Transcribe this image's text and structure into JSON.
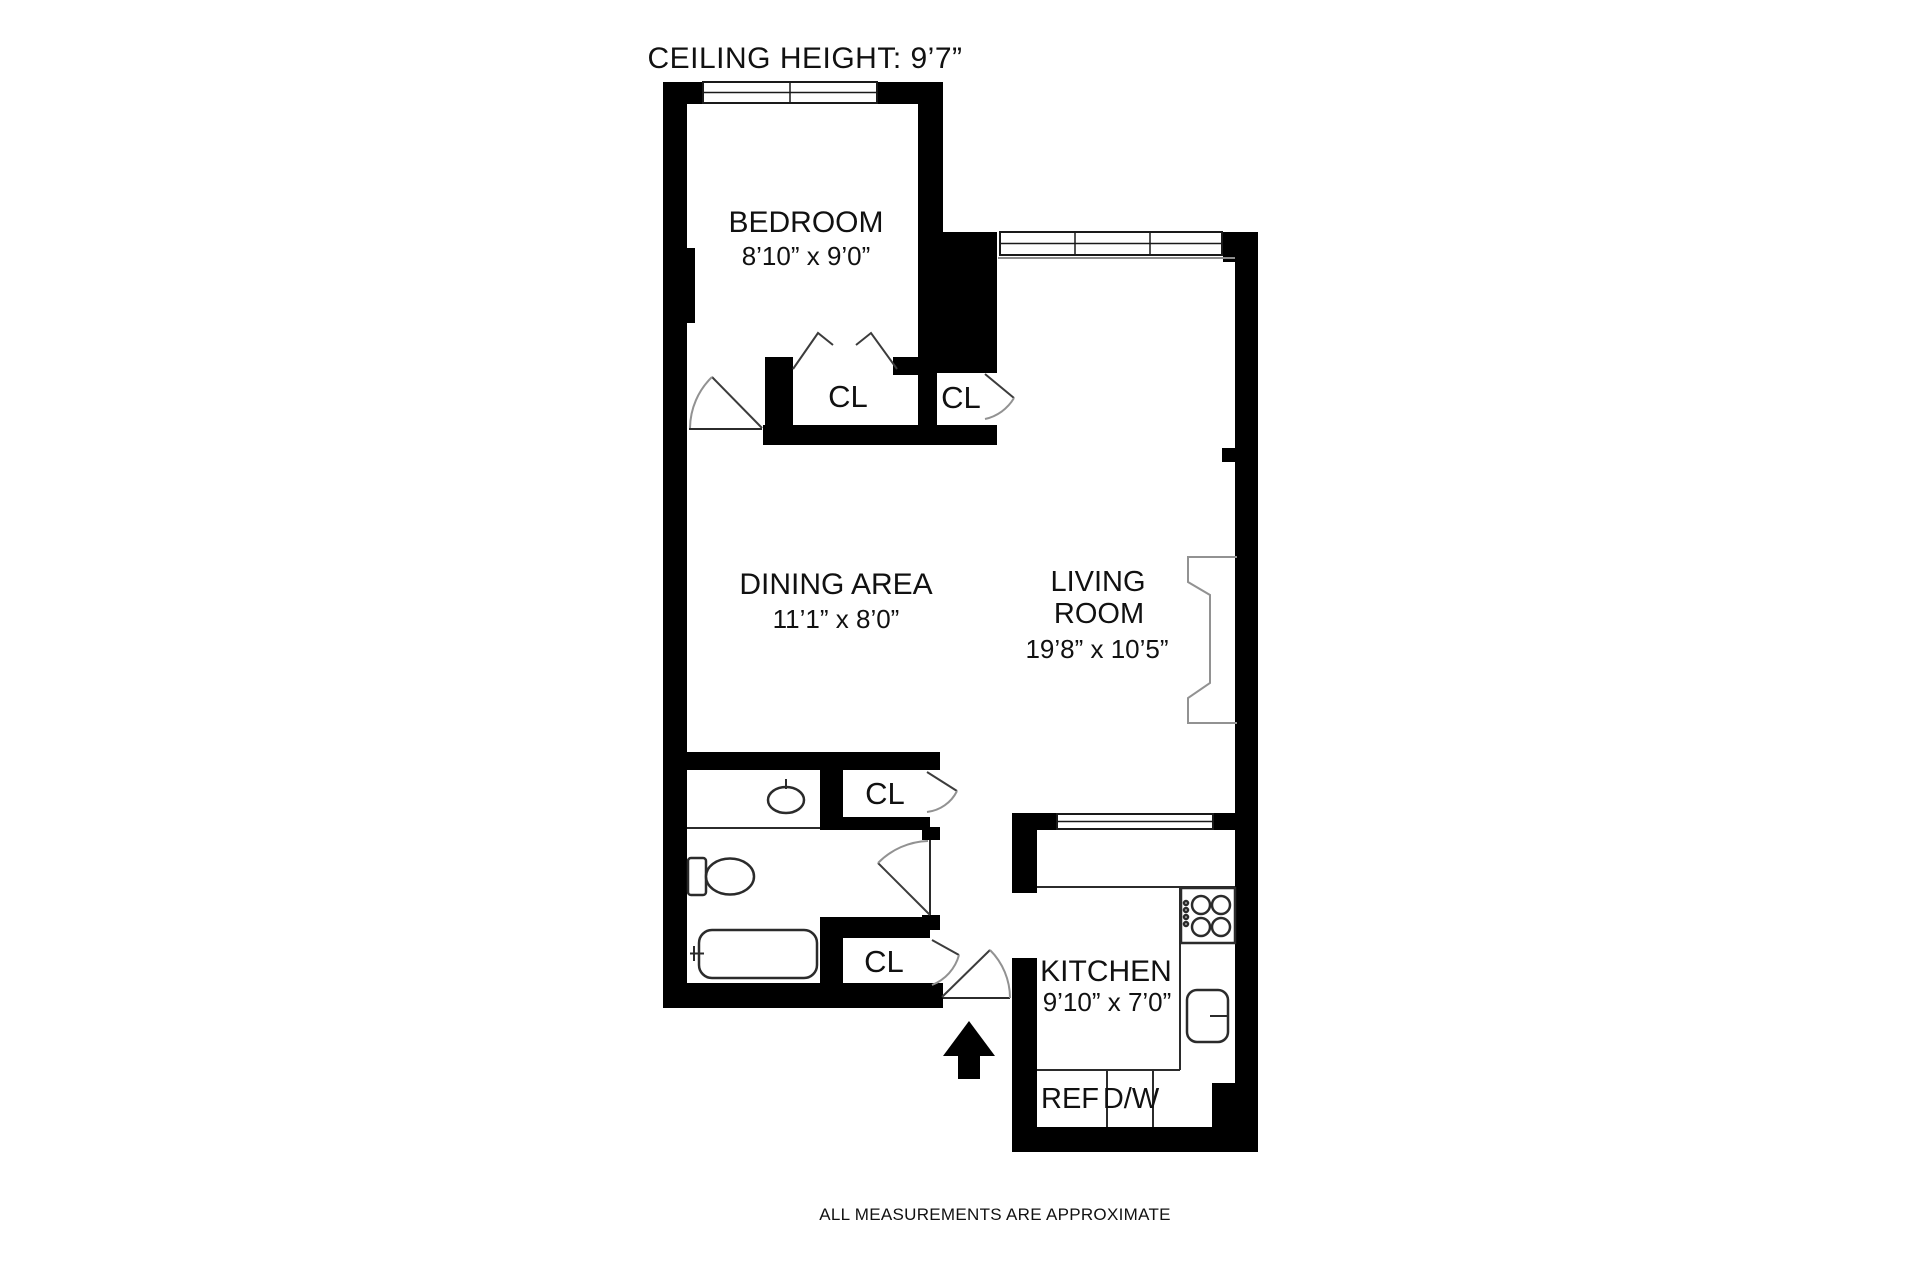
{
  "plan": {
    "title": "CEILING HEIGHT: 9’7”",
    "footer_note": "ALL MEASUREMENTS ARE APPROXIMATE",
    "rooms": {
      "bedroom": {
        "name": "BEDROOM",
        "dims": "8’10” x 9’0”"
      },
      "dining": {
        "name": "DINING AREA",
        "dims": "11’1” x 8’0”"
      },
      "living": {
        "name_line1": "LIVING",
        "name_line2": "ROOM",
        "dims": "19’8” x 10’5”"
      },
      "kitchen": {
        "name": "KITCHEN",
        "dims": "9’10” x 7’0”"
      }
    },
    "closets": {
      "bedroom_closet": "CL",
      "hall_closet_upper": "CL",
      "hall_closet_mid": "CL",
      "hall_closet_lower": "CL"
    },
    "appliances": {
      "refrigerator": "REF",
      "dishwasher": "D/W"
    },
    "icons": {
      "entry_arrow": "solid up arrow marking apartment entrance"
    },
    "colors": {
      "wall": "#000000",
      "background": "#ffffff",
      "text": "#111111",
      "door_arc": "#929292",
      "fixture_stroke": "#2b2b2b"
    }
  }
}
